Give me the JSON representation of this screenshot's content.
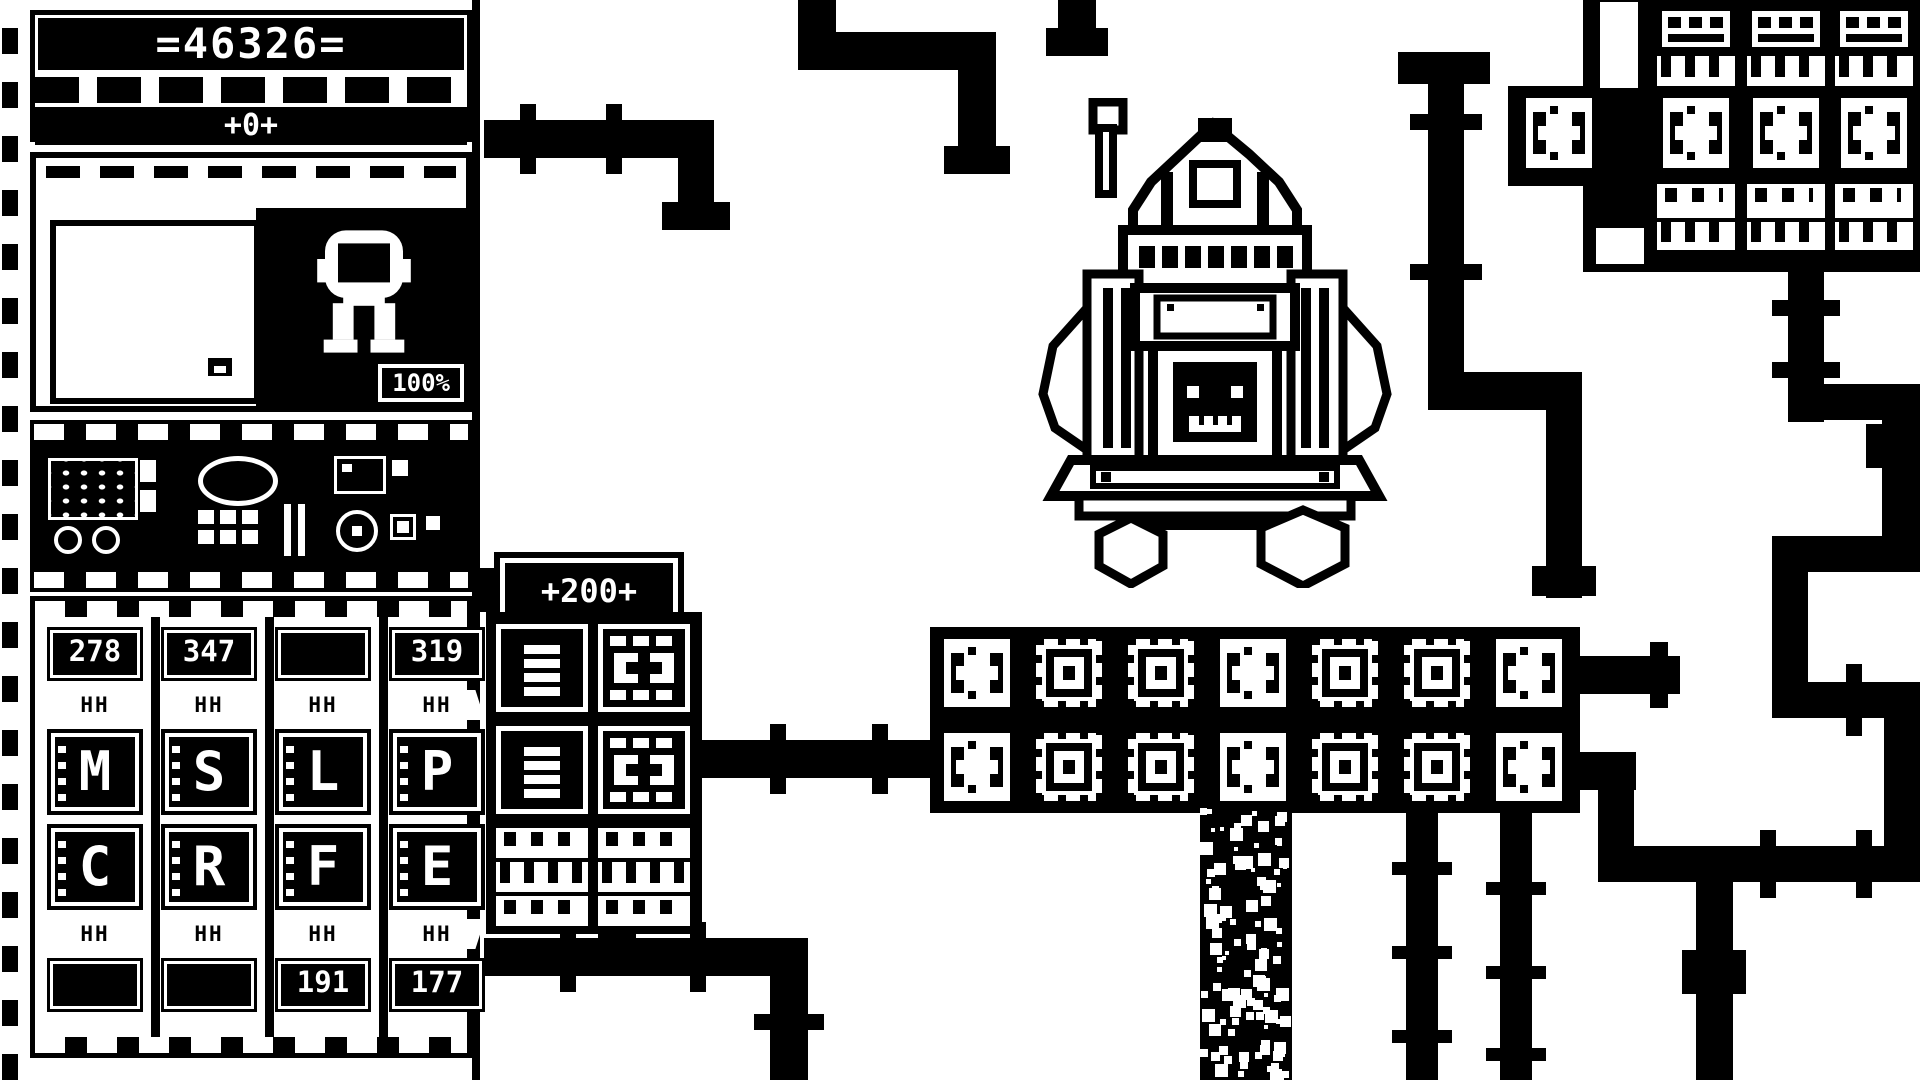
{
  "colors": {
    "ink": "#000000",
    "paper": "#ffffff"
  },
  "hud": {
    "score_counter": "=46326=",
    "score_delta": "+0+",
    "integrity_percent": "100%",
    "rate_badge": "+200+",
    "clamp_glyph": "HH"
  },
  "slots": {
    "top_values": [
      "278",
      "347",
      "",
      "319"
    ],
    "letters_top": [
      "M",
      "S",
      "L",
      "P"
    ],
    "letters_bottom": [
      "C",
      "R",
      "F",
      "E"
    ],
    "bottom_values": [
      "",
      "",
      "191",
      "177"
    ]
  },
  "machine_band": {
    "rows": 2,
    "pattern": [
      "spool",
      "nested",
      "nested",
      "spool",
      "nested",
      "nested",
      "spool"
    ]
  },
  "top_right_grid": {
    "row1": [
      "vent",
      "vent",
      "vent"
    ],
    "row2": [
      "spool",
      "spool",
      "spool",
      "spool"
    ],
    "row3": [
      "ports",
      "ports",
      "ports"
    ]
  },
  "side_stack": {
    "left_column": [
      "doc",
      "doc"
    ],
    "right_column": [
      "coupler",
      "coupler"
    ],
    "footer_rows": [
      "ports",
      "comb",
      "ports"
    ]
  },
  "icons": {
    "map_marker": "map-marker-icon",
    "robot_portrait": "robot-portrait-icon",
    "central_machine": "central-machine-sprite",
    "pipe": "pipe-segment"
  }
}
